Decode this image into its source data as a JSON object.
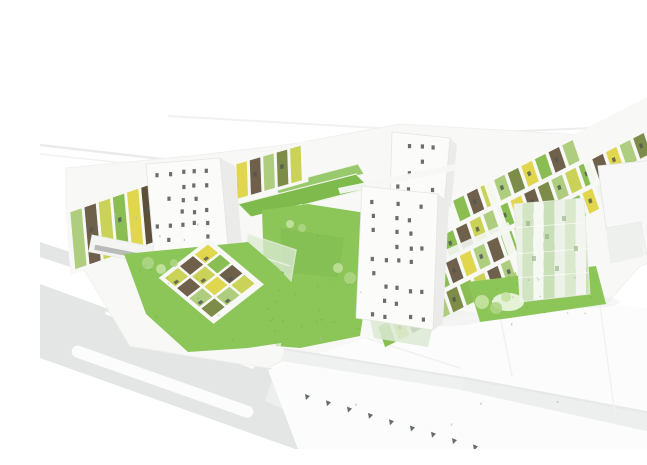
{
  "meta": {
    "type": "architectural-aerial-render",
    "subject": "housing-complex-with-green-roofs",
    "style": "white-massing-3d-visualization"
  },
  "palette": {
    "background": "#ffffff",
    "plinth": "#f8f9f7",
    "road": "#e4e6e6",
    "road_light": "#eceeee",
    "marking": "#fbfcfb",
    "lawn": "#8cc659",
    "lawn_dark": "#79b44a",
    "roof_green": "#7fba4d",
    "roof_green_light": "#93c765",
    "glass": "#dcead3",
    "glass_deep": "#c9dfba",
    "tower": "#fbfbfa",
    "tower_shade": "#ebecea",
    "window": "#50564f",
    "context": "#f7f8f7",
    "context_edge": "#e7e9e8",
    "context_side": "#eef0ee",
    "tree": "#aed584",
    "tree_light": "#c4e29e",
    "tick": "#4c524f",
    "shadow": "#e9ebe8",
    "panel_brown": "#6e604a",
    "panel_darkbrown": "#5d5038",
    "panel_olive": "#7e8c49",
    "panel_yellow": "#e0d74f",
    "panel_yellowgreen": "#cbd258",
    "panel_lightgreen": "#aecd7e",
    "panel_midgreen": "#8abd52"
  },
  "left_strips": {
    "colors": [
      "panel_lightgreen",
      "panel_brown",
      "panel_yellowgreen",
      "panel_midgreen",
      "panel_yellow",
      "panel_darkbrown",
      "panel_olive",
      "panel_lightgreen",
      "panel_yellowgreen",
      "panel_brown"
    ]
  },
  "north_row": {
    "colors": [
      "panel_yellow",
      "panel_brown",
      "panel_lightgreen",
      "panel_olive",
      "panel_yellowgreen"
    ]
  },
  "east_band": {
    "rows": [
      {
        "colors": [
          "panel_midgreen",
          "panel_brown",
          "panel_yellowgreen",
          "panel_lightgreen",
          "panel_olive",
          "panel_yellow",
          "panel_midgreen",
          "panel_brown",
          "panel_lightgreen"
        ]
      },
      {
        "colors": [
          "panel_olive",
          "panel_midgreen",
          "panel_brown",
          "panel_yellowgreen",
          "panel_lightgreen",
          "panel_midgreen",
          "panel_yellow",
          "panel_brown",
          "panel_olive",
          "panel_lightgreen",
          "panel_yellowgreen",
          "panel_midgreen",
          "panel_brown",
          "panel_yellow",
          "panel_lightgreen",
          "panel_olive",
          "panel_midgreen"
        ]
      },
      {
        "colors": [
          "panel_yellowgreen",
          "panel_olive",
          "panel_midgreen",
          "panel_brown",
          "panel_yellow",
          "panel_lightgreen",
          "panel_brown",
          "panel_midgreen",
          "panel_yellowgreen",
          "panel_olive",
          "panel_lightgreen",
          "panel_brown",
          "panel_midgreen",
          "panel_yellow",
          "panel_olive",
          "panel_lightgreen",
          "panel_yellowgreen"
        ]
      },
      {
        "colors": [
          "panel_midgreen",
          "panel_yellowgreen",
          "panel_brown",
          "panel_yellow",
          "panel_lightgreen",
          "panel_olive",
          "panel_midgreen",
          "panel_yellowgreen",
          "panel_brown",
          "panel_lightgreen",
          "panel_yellow",
          "panel_midgreen",
          "panel_olive",
          "panel_yellowgreen"
        ]
      }
    ]
  },
  "patch_grid": {
    "rows": [
      [
        "panel_yellowgreen",
        "panel_brown",
        "panel_yellow"
      ],
      [
        "panel_brown",
        "panel_yellowgreen",
        "panel_midgreen"
      ],
      [
        "panel_lightgreen",
        "panel_yellow",
        "panel_brown"
      ],
      [
        "panel_olive",
        "panel_lightgreen",
        "panel_yellowgreen"
      ]
    ]
  },
  "right_tower": {
    "stripes": [
      "#edf2e8",
      "#d3e4c4",
      "#f6f8f4",
      "#c8dfb7",
      "#edf2e8",
      "#dae8cc",
      "#f3f6f0",
      "#cfe2bf"
    ]
  },
  "street": {
    "tree_tick_count": 9,
    "lane_dash_count": 4,
    "median_island": true
  },
  "towers": {
    "count": 4
  },
  "trees": {
    "count": 10
  }
}
